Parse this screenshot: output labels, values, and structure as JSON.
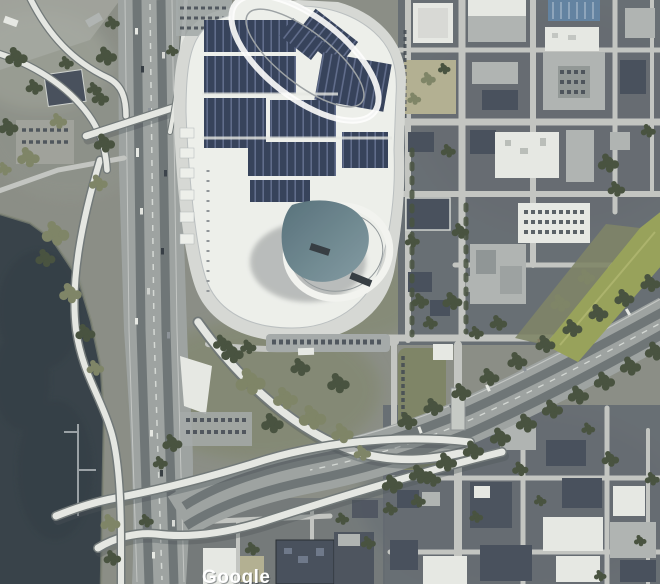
{
  "map": {
    "view_mode": "satellite",
    "attribution": "Google",
    "colors": {
      "water": "#303c45",
      "land": "#878b82",
      "block": "#5d646d",
      "road": "#c2c5c1",
      "rampCasing": "#6c7475",
      "ramp": "#e6e8e4",
      "freeway": "#9ba1a0",
      "lane": "#6a7173",
      "grass": "#95a150",
      "scrub": "#7b8160",
      "tree": "#414c38",
      "arena": "#eff1ed",
      "apron": "#d6d9d5",
      "roofWhite": "#e7e9e5",
      "roofGray": "#aeb3b2",
      "roofDark": "#414a59",
      "sand": "#b2ae8e",
      "parking": "#a3a8a8",
      "solar": "#2e3b58",
      "solarLite": "#5a688c",
      "solarRoofBlue": "#5b7fa3",
      "dome": "#7d99a2",
      "domeDark": "#506d79",
      "watermark": "#ffffff"
    }
  }
}
